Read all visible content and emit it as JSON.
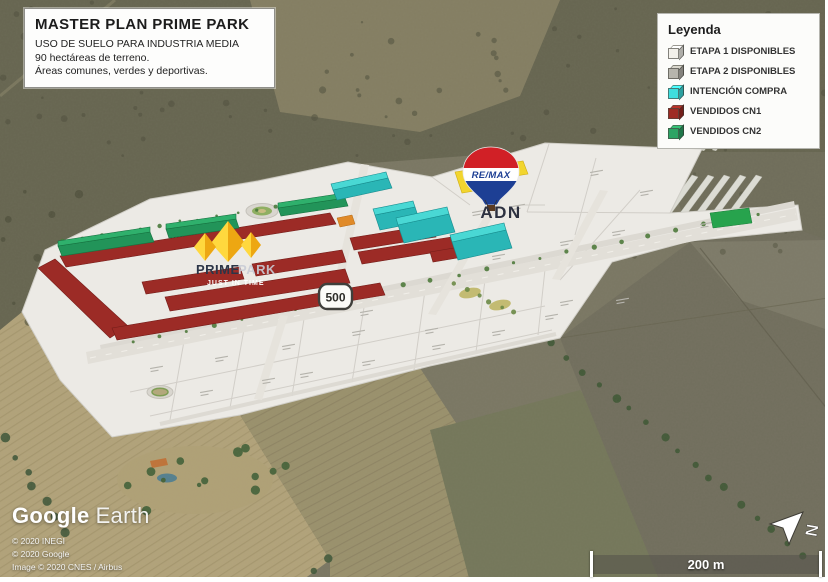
{
  "title_box": {
    "title": "MASTER PLAN PRIME PARK",
    "line1": "USO DE SUELO PARA INDUSTRIA MEDIA",
    "line2": "90 hectáreas de terreno.",
    "line3": "Áreas comunes, verdes y deportivas."
  },
  "legend": {
    "header": "Leyenda",
    "items": [
      {
        "label": "ETAPA 1 DISPONIBLES",
        "color": "#f2f0ea"
      },
      {
        "label": "ETAPA 2 DISPONIBLES",
        "color": "#b7b5ad"
      },
      {
        "label": "INTENCIÓN COMPRA",
        "color": "#3fdede"
      },
      {
        "label": "VENDIDOS CN1",
        "color": "#9e2b24"
      },
      {
        "label": "VENDIDOS CN2",
        "color": "#2da465"
      }
    ]
  },
  "map": {
    "remax_label": "RE/MAX",
    "adn_label": "ADN",
    "brand_prime": "PRIME",
    "brand_park": "PARK",
    "brand_tagline": "JUST IN TIME",
    "road_shield": "500"
  },
  "attribution": {
    "logo_google": "Google",
    "logo_earth": "Earth",
    "line1": "© 2020 INEGI",
    "line2": "© 2020 Google",
    "line3": "Image © 2020 CNES / Airbus"
  },
  "scalebar": {
    "label": "200 m"
  },
  "compass": {
    "label": "N"
  }
}
